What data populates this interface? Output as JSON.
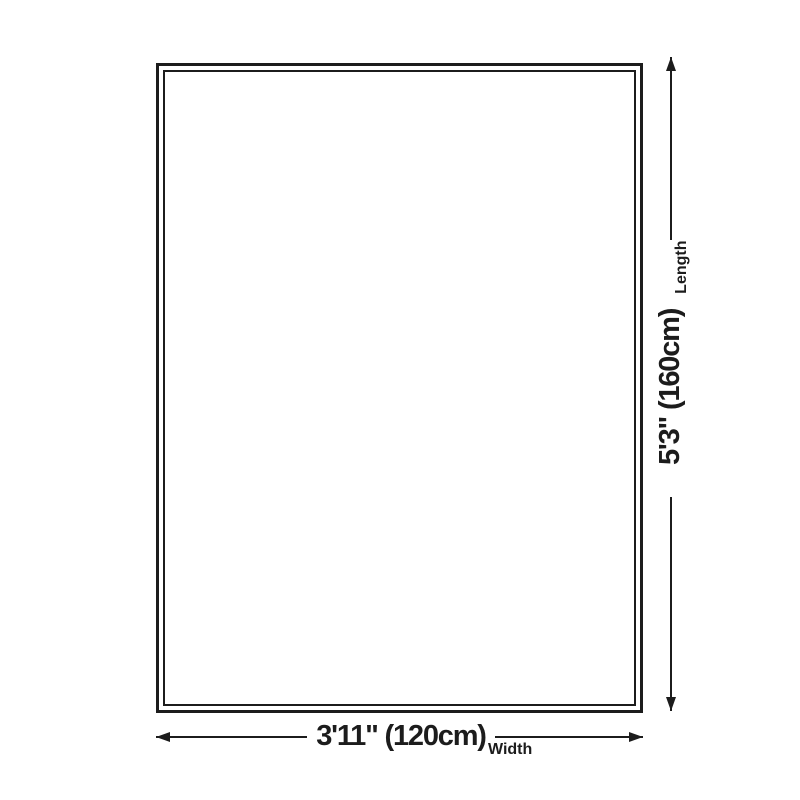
{
  "diagram": {
    "type": "product-size-dimension-diagram",
    "shape": "rectangle-with-double-border",
    "background_color": "#ffffff",
    "line_color": "#1c1c1c",
    "text_color": "#1c1c1c",
    "width": {
      "value": "3'11\" (120cm)",
      "label": "Width"
    },
    "length": {
      "value": "5'3\" (160cm)",
      "label": "Length"
    },
    "icons": {
      "horizontal_arrowheads": [
        "arrowhead-left-icon",
        "arrowhead-right-icon"
      ],
      "vertical_arrowheads": [
        "arrowhead-down-icon",
        "arrowhead-up-icon"
      ]
    }
  }
}
